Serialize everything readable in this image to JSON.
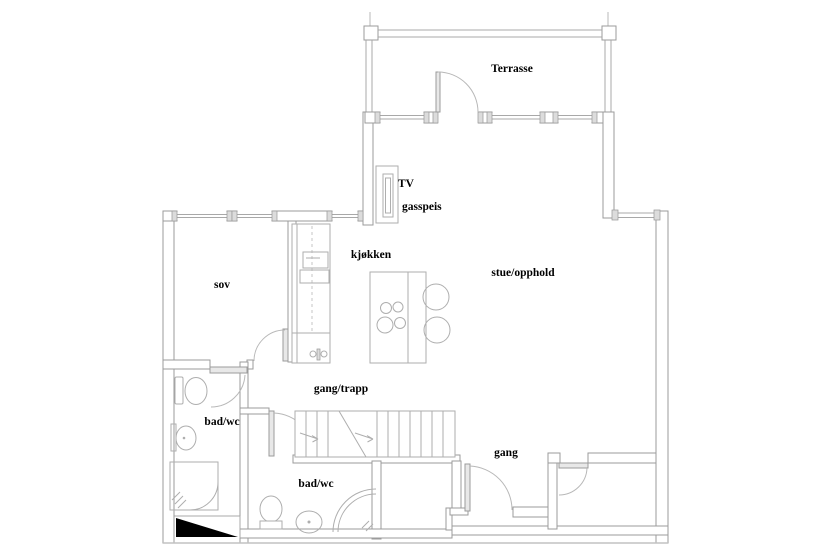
{
  "drawing": {
    "type": "architectural floor plan",
    "language": "Norwegian"
  },
  "rooms": {
    "terrasse": {
      "label": "Terrasse"
    },
    "sov": {
      "label": "sov"
    },
    "kjokken": {
      "label": "kjøkken"
    },
    "stue_opphold": {
      "label": "stue/opphold"
    },
    "gang_trapp": {
      "label": "gang/trapp"
    },
    "bad_wc_upper": {
      "label": "bad/wc"
    },
    "bad_wc_lower": {
      "label": "bad/wc"
    },
    "gang": {
      "label": "gang"
    }
  },
  "annotations": {
    "tv": {
      "label": "TV"
    },
    "gasspeis": {
      "label": "gasspeis"
    }
  },
  "symbols": {
    "toilet": "toilet",
    "washbasin": "washbasin",
    "shower": "shower",
    "cooktop": "cooktop-4-burners",
    "bar_stool": "round stool",
    "stairs": "staircase with break line and up-arrows",
    "ramp": "black filled ramp triangle",
    "fireplace": "wall-mounted TV / gas fireplace unit",
    "window": "double-line window with jamb blocks",
    "door": "door leaf with quarter-circle swing arc"
  },
  "colors": {
    "background": "#ffffff",
    "wall_line": "#9b9b9b",
    "light_line": "#b8b8b8",
    "label_text": "#000000",
    "ramp_fill": "#000000"
  }
}
